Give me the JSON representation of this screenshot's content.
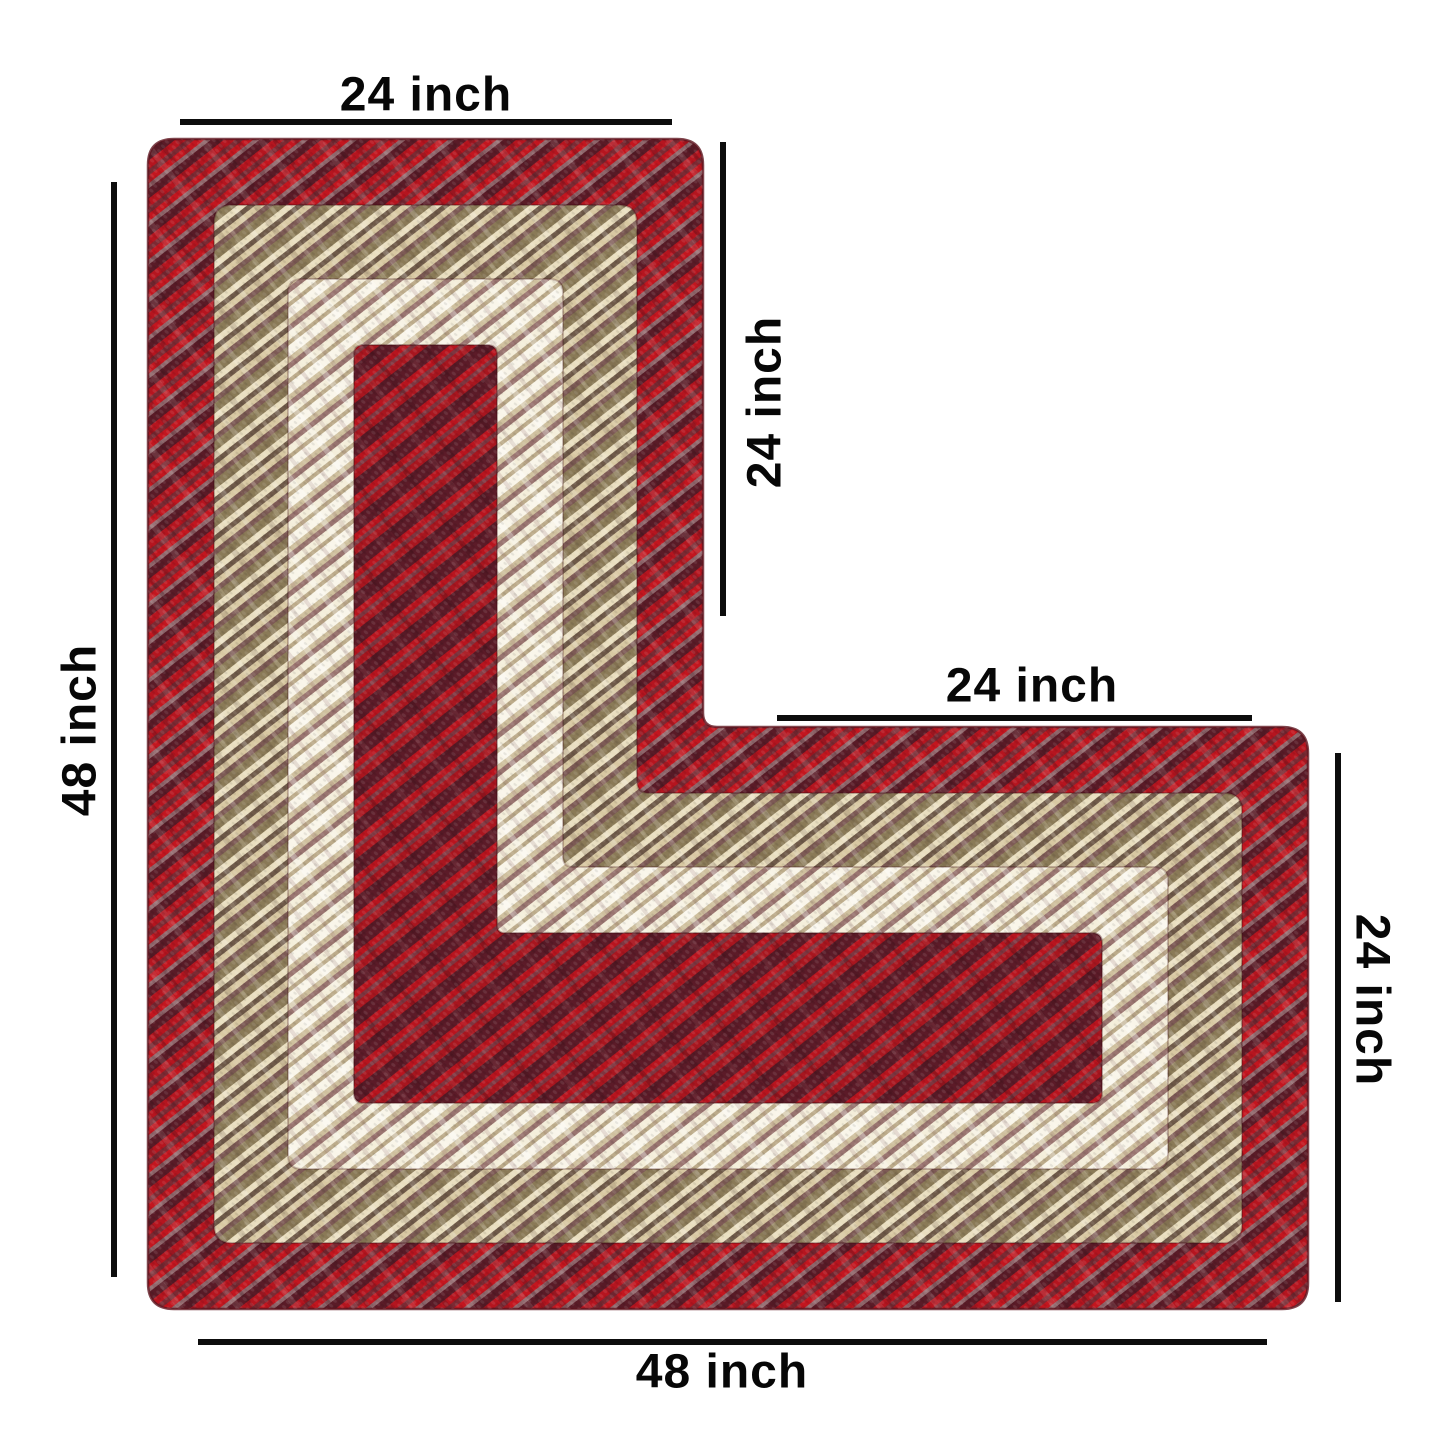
{
  "image": {
    "title": "L-shaped braided corner rug with dimension annotations",
    "background": "#ffffff",
    "annotation_color": "#0d0d0d"
  },
  "dimensions": {
    "top_width": "24 inch",
    "upper_right_height": "24 inch",
    "arm_top_width": "24 inch",
    "lower_right_height": "24 inch",
    "left_height": "48 inch",
    "bottom_width": "48 inch"
  },
  "rug": {
    "shape": "L-shaped braided rug",
    "bands": [
      {
        "name": "outer-red-houndstooth",
        "colors": [
          "#a41520",
          "#5a1b27",
          "#b5151f",
          "#8f666b",
          "#c3161f"
        ]
      },
      {
        "name": "tan-brown-houndstooth",
        "colors": [
          "#c2b08a",
          "#8a7a57",
          "#e9debf",
          "#6f5a49",
          "#7d5a55"
        ]
      },
      {
        "name": "cream-houndstooth",
        "colors": [
          "#efe7d0",
          "#f9f5e9",
          "#cfc09e",
          "#9a7570",
          "#bcab8a"
        ]
      },
      {
        "name": "center-dark-red",
        "colors": [
          "#9c1420",
          "#5c1b28",
          "#b8141e",
          "#7e3640"
        ]
      }
    ]
  }
}
